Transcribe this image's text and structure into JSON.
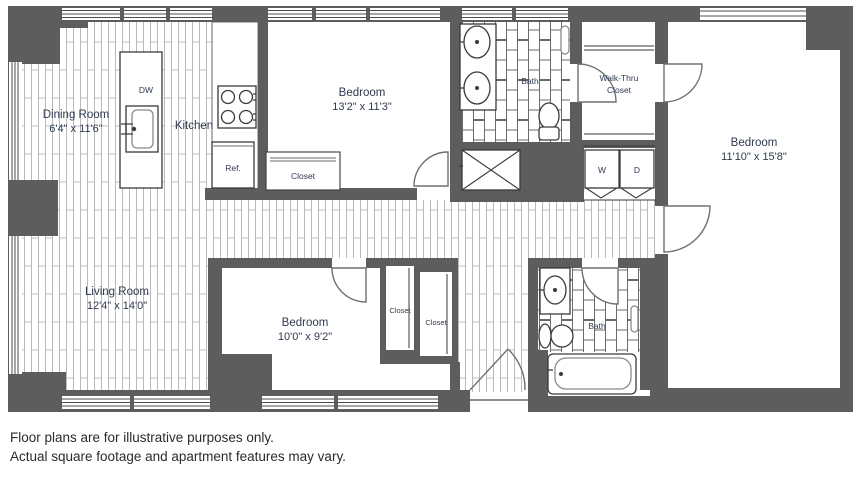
{
  "plan": {
    "rooms": [
      {
        "id": "dining-room",
        "name": "Dining Room",
        "dims": "6'4\" x 11'6\""
      },
      {
        "id": "kitchen",
        "name": "Kitchen",
        "dims": ""
      },
      {
        "id": "bedroom-top",
        "name": "Bedroom",
        "dims": "13'2\" x 11'3\""
      },
      {
        "id": "bath-top",
        "name": "Bath",
        "dims": ""
      },
      {
        "id": "walk-thru-closet",
        "name": "Walk-Thru Closet",
        "line1": "Walk-Thru",
        "line2": "Closet"
      },
      {
        "id": "bedroom-right",
        "name": "Bedroom",
        "dims": "11'10\" x 15'8\""
      },
      {
        "id": "living-room",
        "name": "Living Room",
        "dims": "12'4\" x 14'0\""
      },
      {
        "id": "bedroom-bottom",
        "name": "Bedroom",
        "dims": "10'0\" x 9'2\""
      },
      {
        "id": "closet-mid-left",
        "name": "Closet"
      },
      {
        "id": "closet-mid-right",
        "name": "Closet"
      },
      {
        "id": "bath-bottom",
        "name": "Bath"
      },
      {
        "id": "closet-bedroom-top",
        "name": "Closet"
      }
    ],
    "fixtures": {
      "dishwasher": "DW",
      "refrigerator": "Ref.",
      "washer": "W",
      "dryer": "D"
    },
    "colors": {
      "wall": "#5d5d5d",
      "label": "#2e3a50",
      "wood_line": "#a9a9a9",
      "tile_line": "#6a6a6a",
      "fixture_line": "#3a3a3a"
    }
  },
  "disclaimer": {
    "line1": "Floor plans are for illustrative purposes only.",
    "line2": "Actual square footage and apartment features may vary."
  }
}
